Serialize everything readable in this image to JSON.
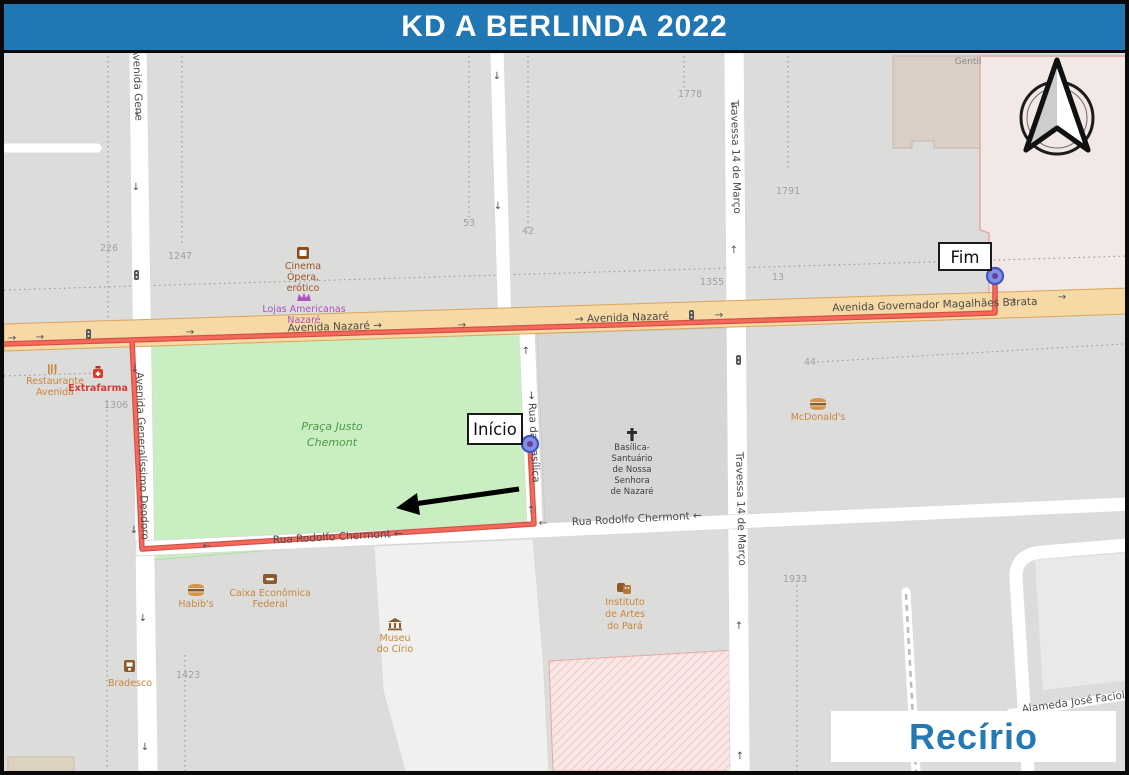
{
  "title": "KD A BERLINDA 2022",
  "event_label": "Recírio",
  "markers": {
    "start": "Início",
    "end": "Fim"
  },
  "park": {
    "line1": "Praça Justo",
    "line2": "Chemont"
  },
  "streets": {
    "nazare_w": "Avenida Nazaré →",
    "nazare_e": "→ Avenida Nazaré",
    "magalhaes": "Avenida Governador Magalhães Barata",
    "deodoro": "Avenida Generalíssimo Deodoro",
    "travessa": "Travessa 14 de Março",
    "rua_basilica": "→ Rua da Basílica",
    "rodolfo": "Rua Rodolfo Chermont ←",
    "faciola": "Alameda José Faciola",
    "building_partial": "Gentil"
  },
  "pois": {
    "cinema": {
      "lines": [
        "Cinema",
        "Ópera,",
        "erótico"
      ]
    },
    "lojas": {
      "lines": [
        "Lojas Americanas",
        "Nazaré"
      ]
    },
    "restaurante": {
      "lines": [
        "Restaurante",
        "Avenida"
      ]
    },
    "extrafarma": {
      "label": "Extrafarma"
    },
    "mcdonalds": {
      "label": "McDonald's"
    },
    "habibs": {
      "label": "Habib's"
    },
    "bradesco": {
      "label": "Bradesco"
    },
    "caixa": {
      "lines": [
        "Caixa Econômica",
        "Federal"
      ]
    },
    "museu": {
      "lines": [
        "Museu",
        "do Círio"
      ]
    },
    "iap": {
      "lines": [
        "Instituto",
        "de Artes",
        "do Pará"
      ]
    },
    "basilica": {
      "lines": [
        "Basílica-",
        "Santuário",
        "de Nossa",
        "Senhora",
        "de Nazaré"
      ]
    }
  },
  "house_numbers": [
    "226",
    "1247",
    "53",
    "42",
    "1778",
    "1791",
    "1355",
    "13",
    "44",
    "1306",
    "1423",
    "1933"
  ],
  "icons": {
    "arrow_right": "→",
    "arrow_left": "←",
    "arrow_up": "↑",
    "arrow_down": "↓"
  },
  "colors": {
    "banner_blue": "#2176b4",
    "recirio_blue": "#2478b4",
    "route_red": "#f05a4c",
    "avenue_fill": "#f6d9a4",
    "park_green": "#c9eec1",
    "marker_blue": "#8090e2"
  }
}
